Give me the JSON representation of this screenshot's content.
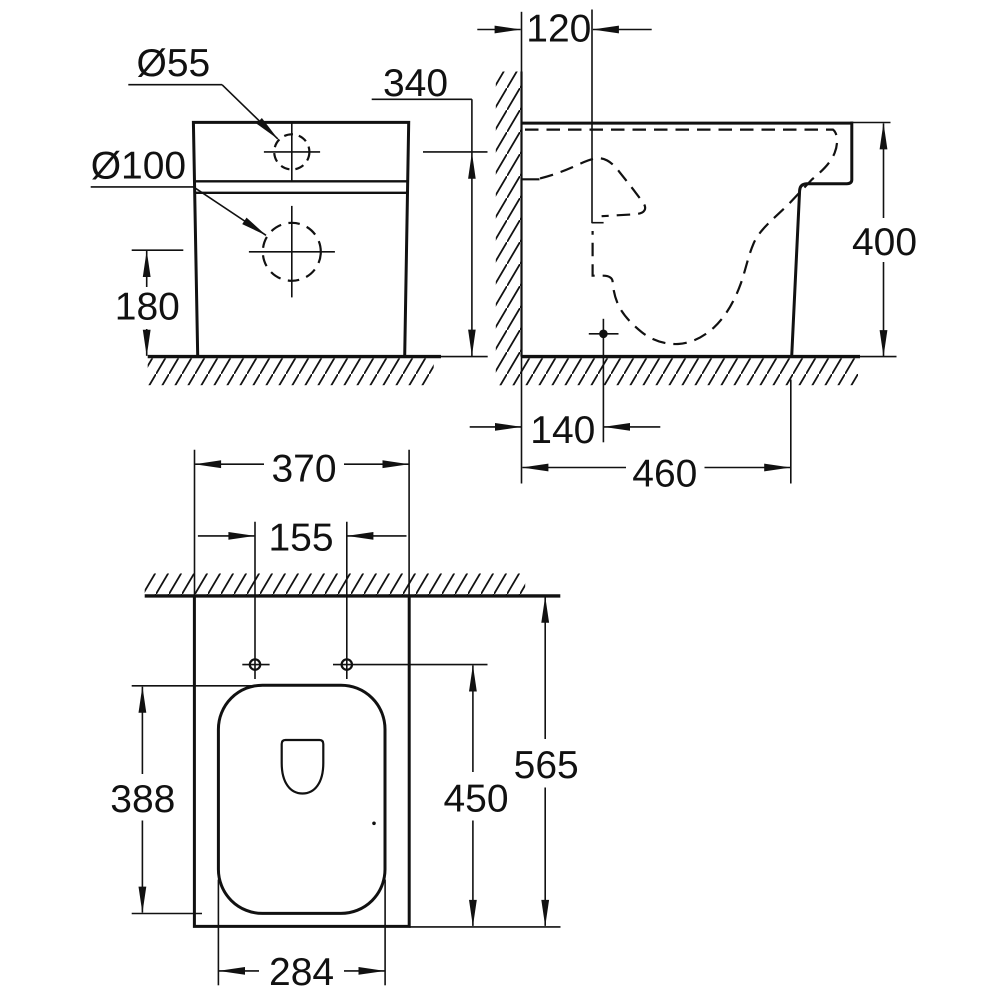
{
  "page": {
    "background": "#ffffff",
    "line_color": "#111111",
    "kind": "technical-dimension-drawing",
    "subject": "floor-standing toilet, three orthographic views"
  },
  "front_view": {
    "inlet_diameter_label": "Ø55",
    "outlet_diameter_label": "Ø100",
    "inlet_height": "340",
    "outlet_height": "180"
  },
  "side_view": {
    "inlet_wall_offset": "120",
    "height": "400",
    "outlet_wall_offset": "140",
    "floor_depth": "460"
  },
  "top_view": {
    "width": "370",
    "fixing_hole_spacing": "155",
    "seat_cutout_length": "388",
    "fixing_hole_depth": "450",
    "total_depth": "565",
    "seat_cutout_width": "284"
  }
}
